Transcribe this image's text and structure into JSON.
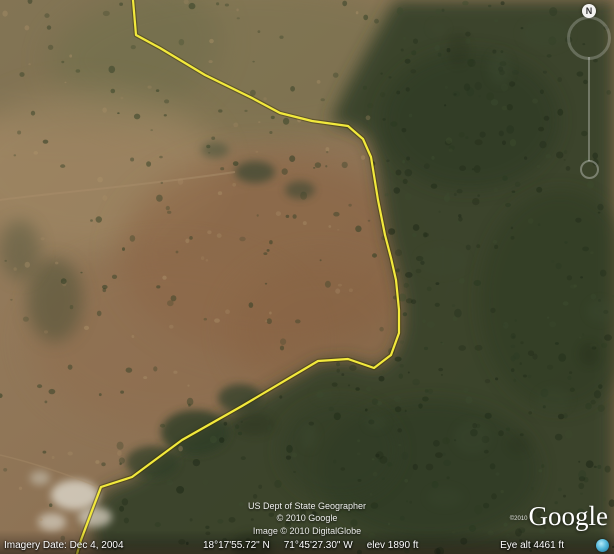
{
  "app": {
    "name": "Google Earth satellite view"
  },
  "map_overlay": {
    "boundary_color": "#f2e93c",
    "boundary_points": "133,0 136,35 160,48 205,75 252,98 280,113 312,121 348,126 363,139 371,157 378,200 385,235 391,258 396,280 399,310 399,333 391,355 374,368 348,359 318,361 242,406 182,440 132,477 101,487 93,508 81,540 77,554"
  },
  "attribution": {
    "line1": "US Dept of State Geographer",
    "line2": "© 2010 Google",
    "line3": "Image © 2010 DigitalGlobe"
  },
  "watermark": {
    "copyright": "©2010",
    "logo": "Google"
  },
  "status_bar": {
    "imagery_date": "Imagery Date: Dec 4, 2004",
    "latitude": "18°17'55.72\" N",
    "longitude": "71°45'27.30\" W",
    "elevation": "elev 1890 ft",
    "eye_altitude": "Eye alt 4461 ft"
  },
  "navigation": {
    "north_label": "N"
  },
  "colors": {
    "forest": "#37422b",
    "field": "#8e7355",
    "stream_icon": "#54b8da"
  }
}
